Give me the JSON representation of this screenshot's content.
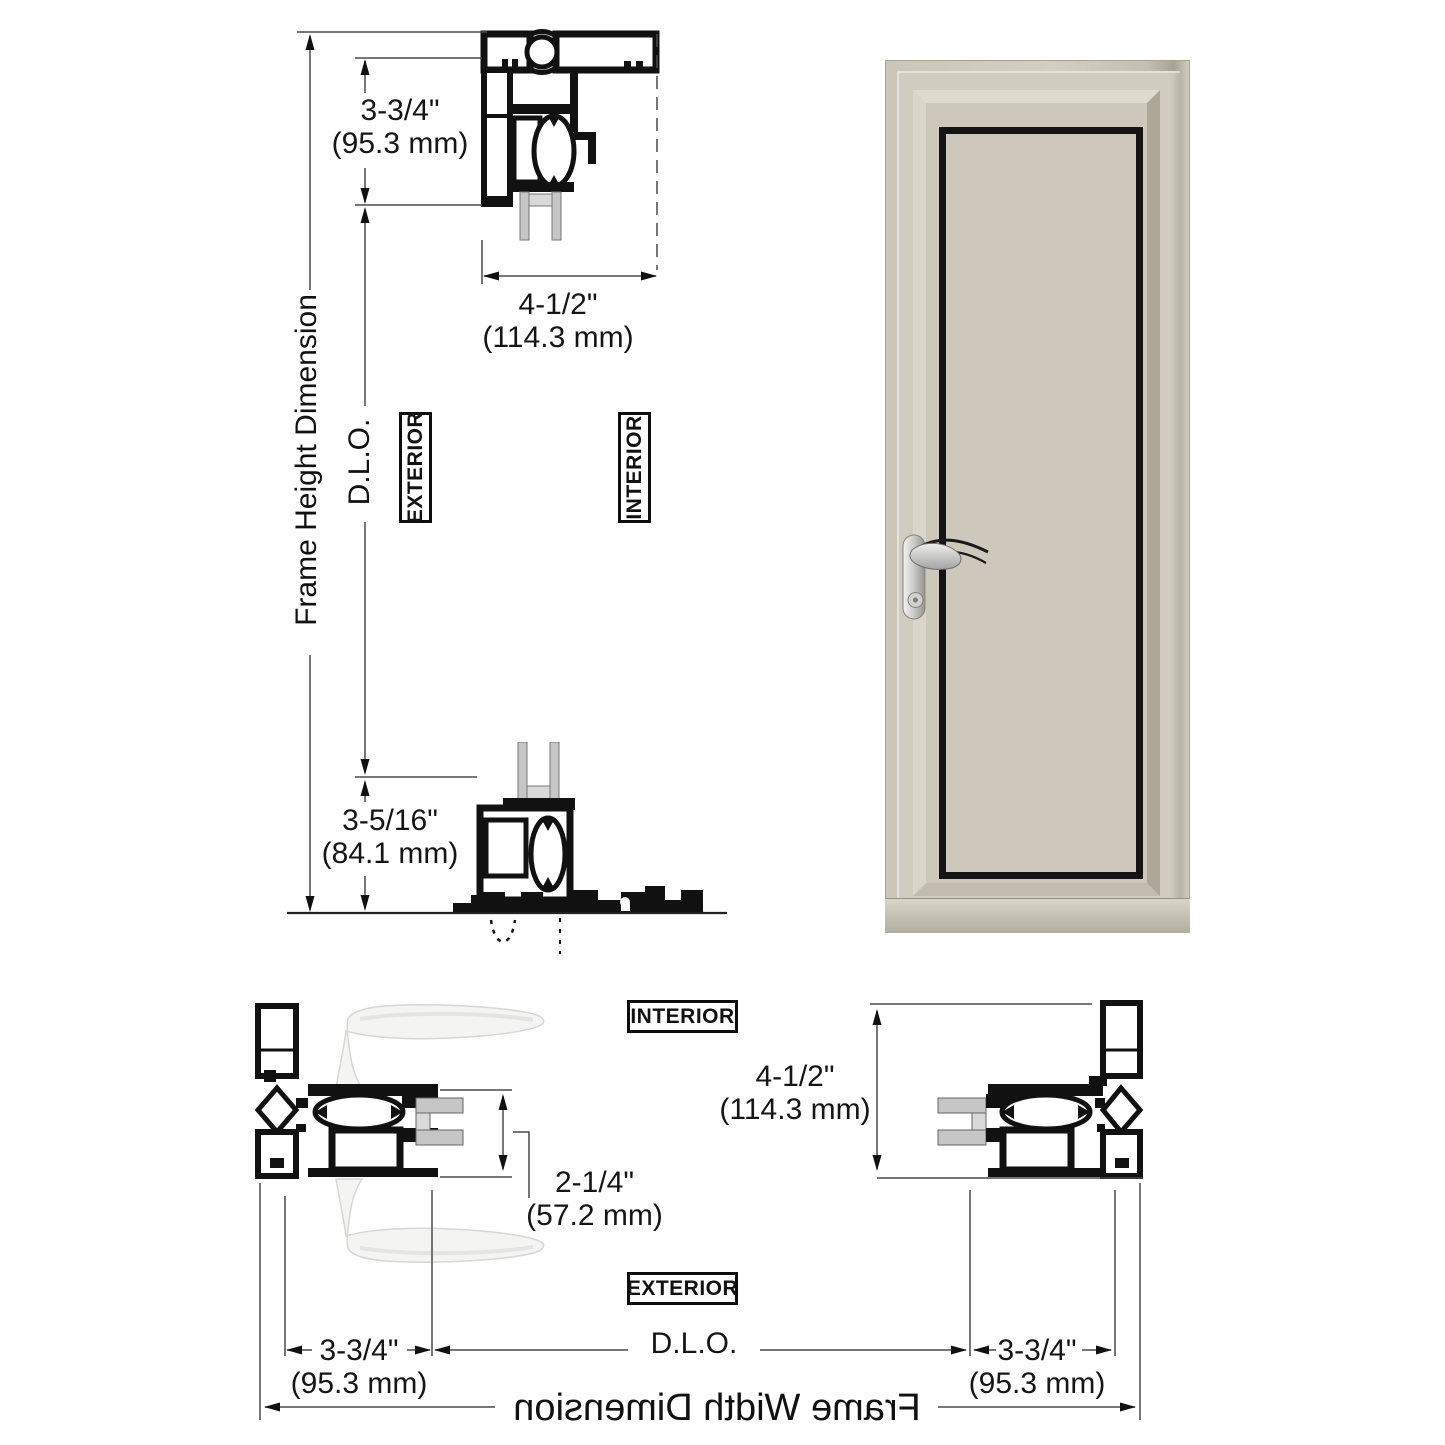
{
  "title": "Aluminum door frame section detail drawing",
  "colors": {
    "line_gray": "#4a4a4a",
    "drawing_black": "#111111",
    "frame_beige": "#cdc8bb",
    "glass_gray": "#d2d7d4"
  },
  "labels": {
    "frame_height": "Frame Height Dimension",
    "frame_width": "Frame Width Dimension",
    "dlo_vertical": "D.L.O.",
    "dlo_horizontal": "D.L.O.",
    "exterior_top": "EXTERIOR",
    "interior_top": "INTERIOR",
    "interior_bottom": "INTERIOR",
    "exterior_bottom": "EXTERIOR"
  },
  "dimensions": {
    "head_height": {
      "inches": "3-3/4\"",
      "mm": "(95.3 mm)"
    },
    "frame_depth_top": {
      "inches": "4-1/2\"",
      "mm": "(114.3 mm)"
    },
    "sill_height": {
      "inches": "3-5/16\"",
      "mm": "(84.1 mm)"
    },
    "glazing_thickness": {
      "inches": "2-1/4\"",
      "mm": "(57.2 mm)"
    },
    "frame_depth_side": {
      "inches": "4-1/2\"",
      "mm": "(114.3 mm)"
    },
    "lock_jamb_width": {
      "inches": "3-3/4\"",
      "mm": "(95.3 mm)"
    },
    "hinge_jamb_width": {
      "inches": "3-3/4\"",
      "mm": "(95.3 mm)"
    }
  }
}
